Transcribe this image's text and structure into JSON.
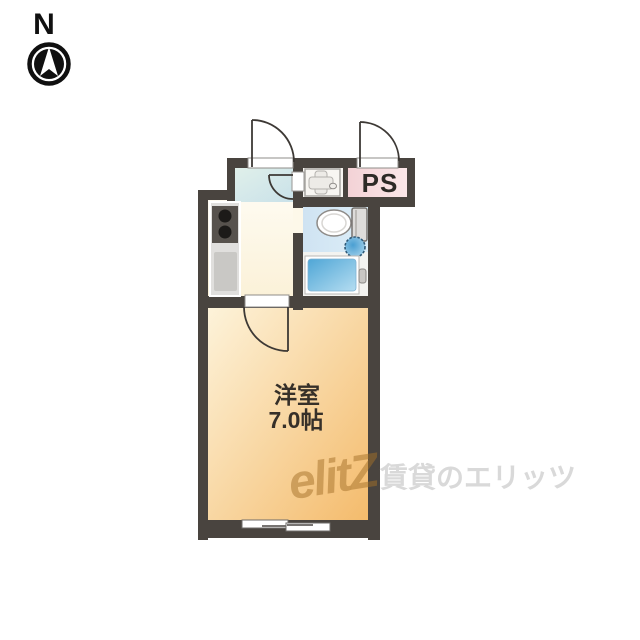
{
  "compass": {
    "north_label": "N"
  },
  "floor_plan": {
    "rooms": {
      "main_room": {
        "name": "洋室",
        "size": "7.0帖"
      },
      "pipe_space": {
        "label": "PS"
      },
      "entrance": {
        "label": ""
      },
      "kitchen": {
        "label": ""
      },
      "bathroom": {
        "label": ""
      }
    },
    "fixtures": [
      "stove",
      "kitchen-sink",
      "washing-machine-pan",
      "toilet",
      "wash-basin",
      "bathtub",
      "sliding-window"
    ]
  },
  "watermark": {
    "logo": "elitZ",
    "brand": "賃貸のエリッツ"
  },
  "colors": {
    "wall": "#49443f",
    "main_room_floor_start": "#fdf3da",
    "main_room_floor_end": "#f4bb6c",
    "entrance_floor_start": "#e0f0ea",
    "entrance_floor_end": "#c9e1e9",
    "kitchen_floor_start": "#fefbf1",
    "kitchen_floor_end": "#fbf1d8",
    "bathroom_floor_start": "#cfe3f2",
    "bathroom_floor_end": "#ddeef8",
    "bathtub_start": "#4fa6d6",
    "bathtub_end": "#b5ddf1",
    "pipe_space_start": "#f3d2d6",
    "pipe_space_end": "#fbe7e8",
    "door_line": "#3d3935",
    "label_text": "#363029",
    "watermark_gray": "#d9d9d9",
    "watermark_logo": "#a47028"
  }
}
